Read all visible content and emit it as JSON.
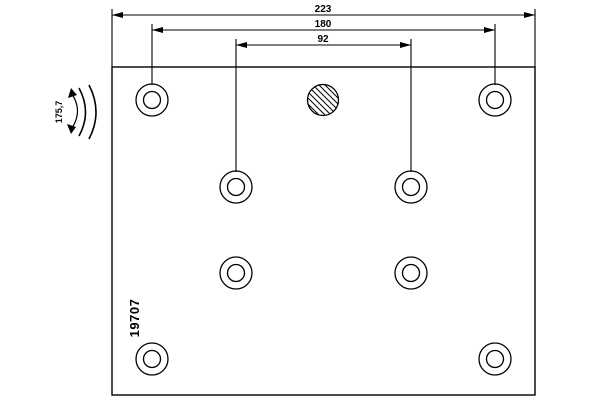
{
  "drawing": {
    "part_number": "19707",
    "dimensions": {
      "overall_length": "223",
      "outer_hole_spacing": "180",
      "inner_hole_spacing": "92"
    },
    "radius_label": "175,7",
    "colors": {
      "line": "#000000",
      "background": "#ffffff"
    }
  }
}
